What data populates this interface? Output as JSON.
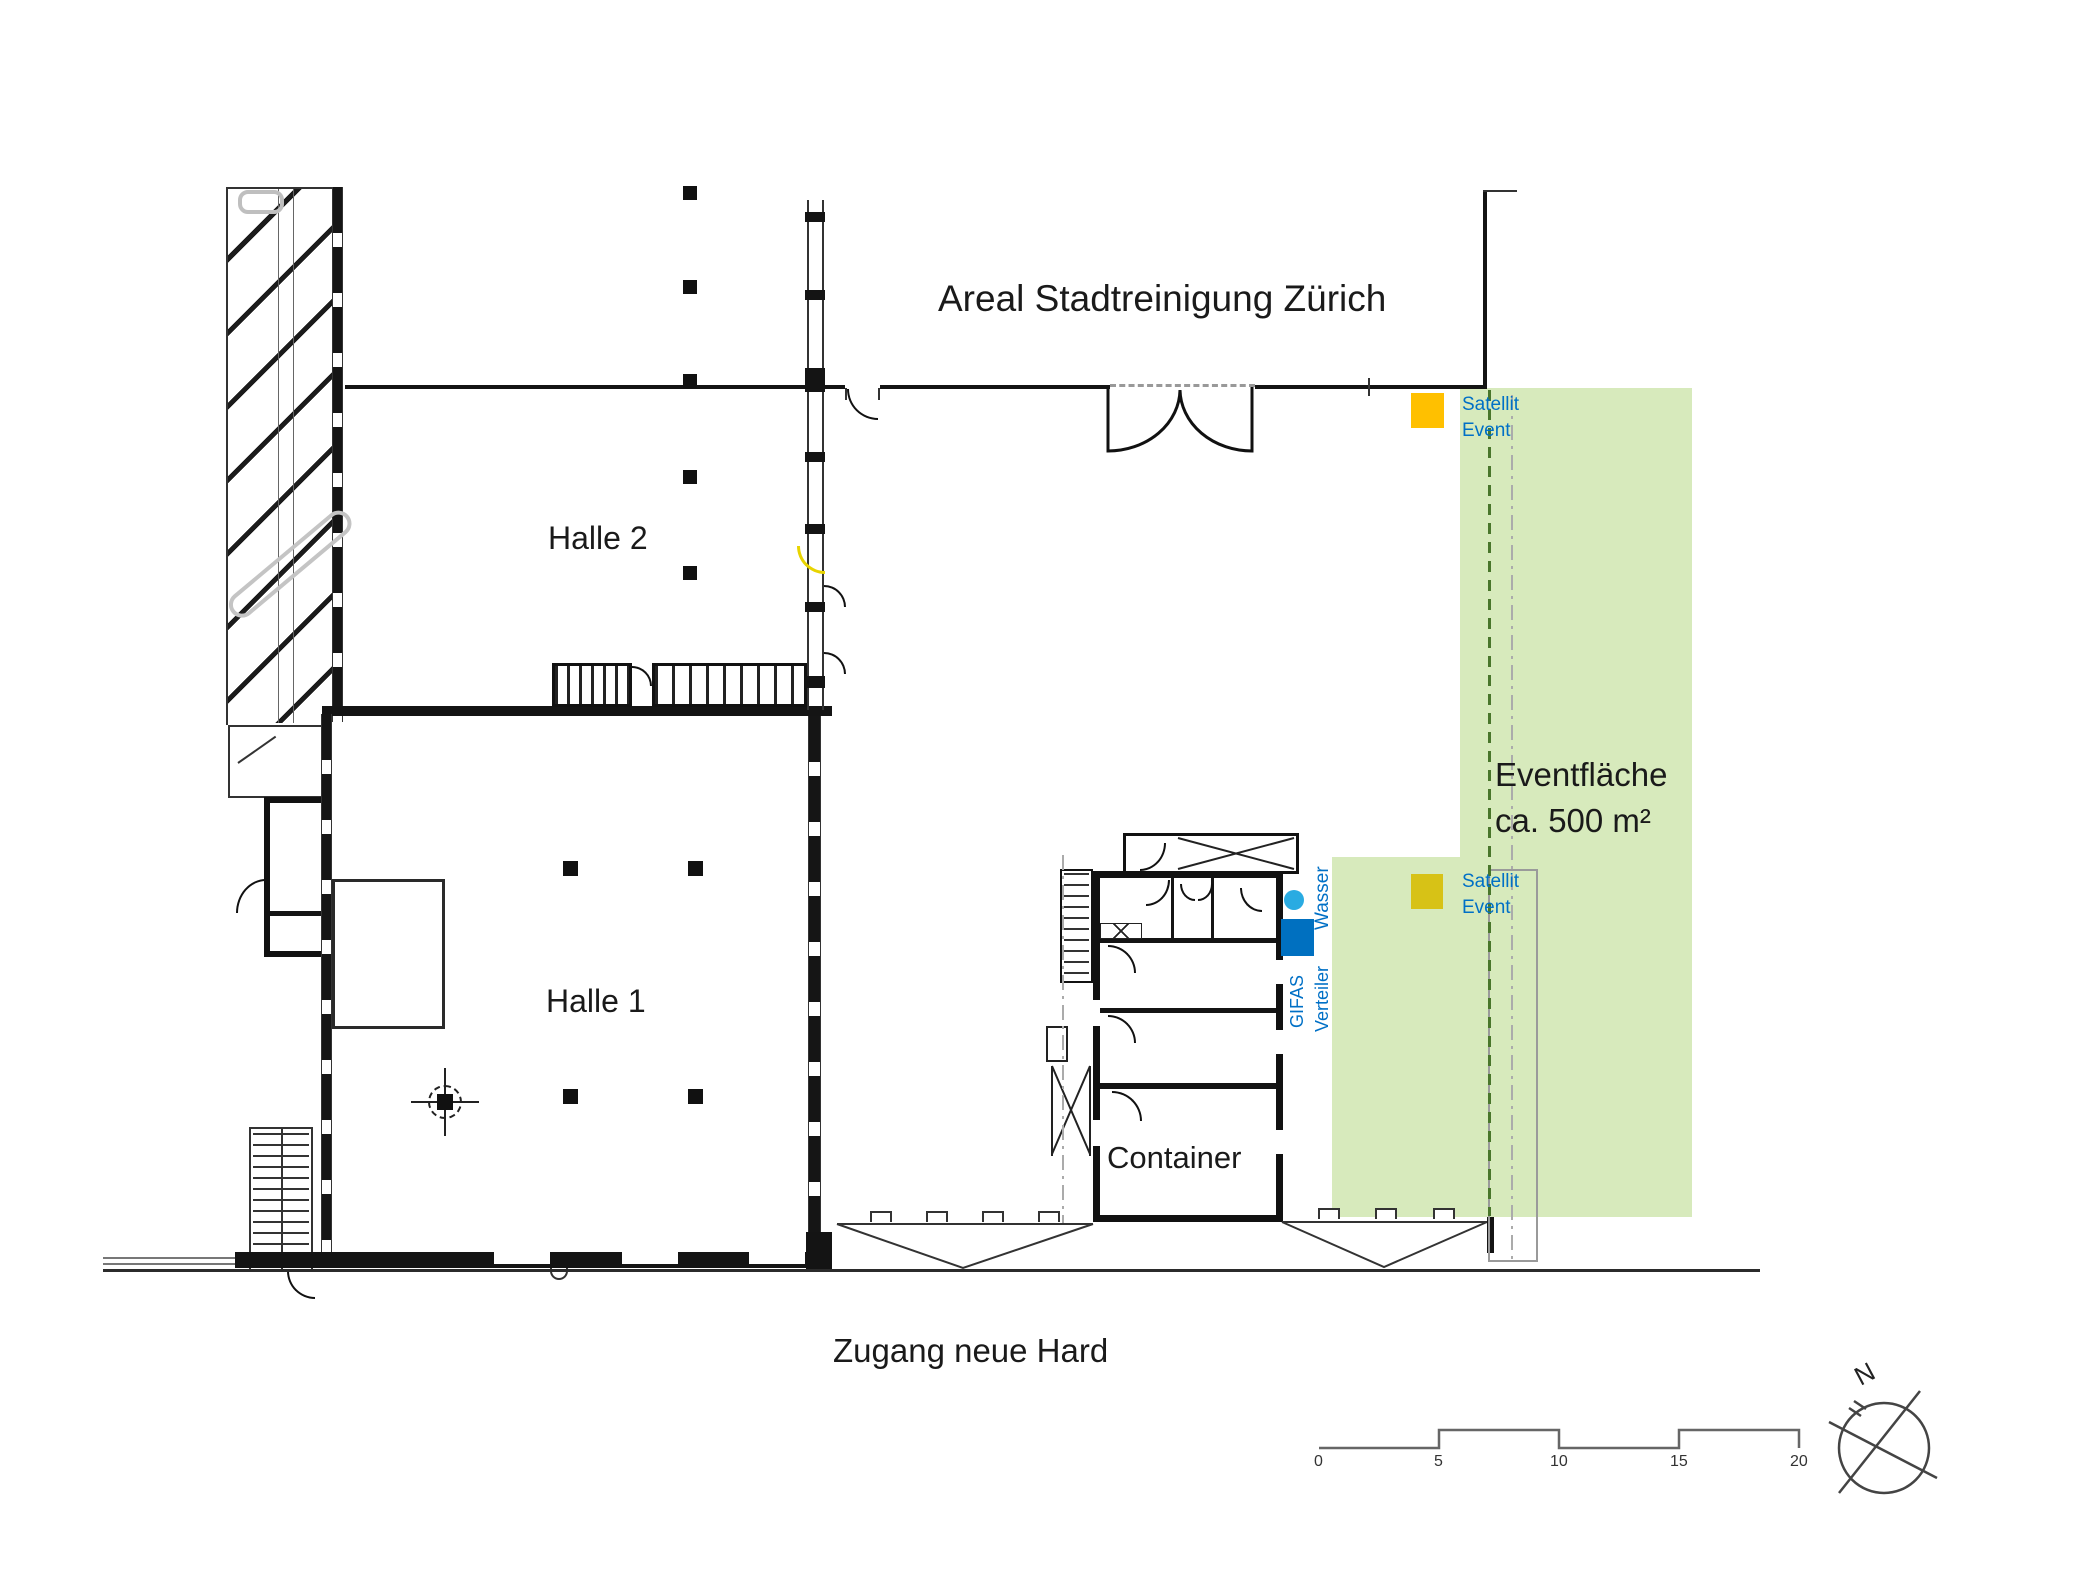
{
  "title": "Areal Stadtreinigung Zürich",
  "rooms": {
    "halle1": "Halle 1",
    "halle2": "Halle 2",
    "container": "Container"
  },
  "event_area": {
    "line1": "Eventfläche",
    "line2": "ca. 500 m²",
    "fill_color": "#D9EBBC"
  },
  "markers": {
    "satellit_top": {
      "line1": "Satellit",
      "line2": "Event",
      "color": "#FFC000"
    },
    "satellit_bottom": {
      "line1": "Satellit",
      "line2": "Event",
      "color": "#D7C216"
    },
    "gifas": {
      "line1": "GIFAS",
      "line2": "Verteiler",
      "color": "#0070C0"
    },
    "wasser": {
      "label": "Wasser",
      "color": "#29ABE2"
    },
    "text_color": "#0070C6"
  },
  "access_label": "Zugang neue Hard",
  "scalebar": {
    "labels": [
      "0",
      "5",
      "10",
      "15",
      "20"
    ]
  },
  "compass": {
    "north": "N"
  }
}
